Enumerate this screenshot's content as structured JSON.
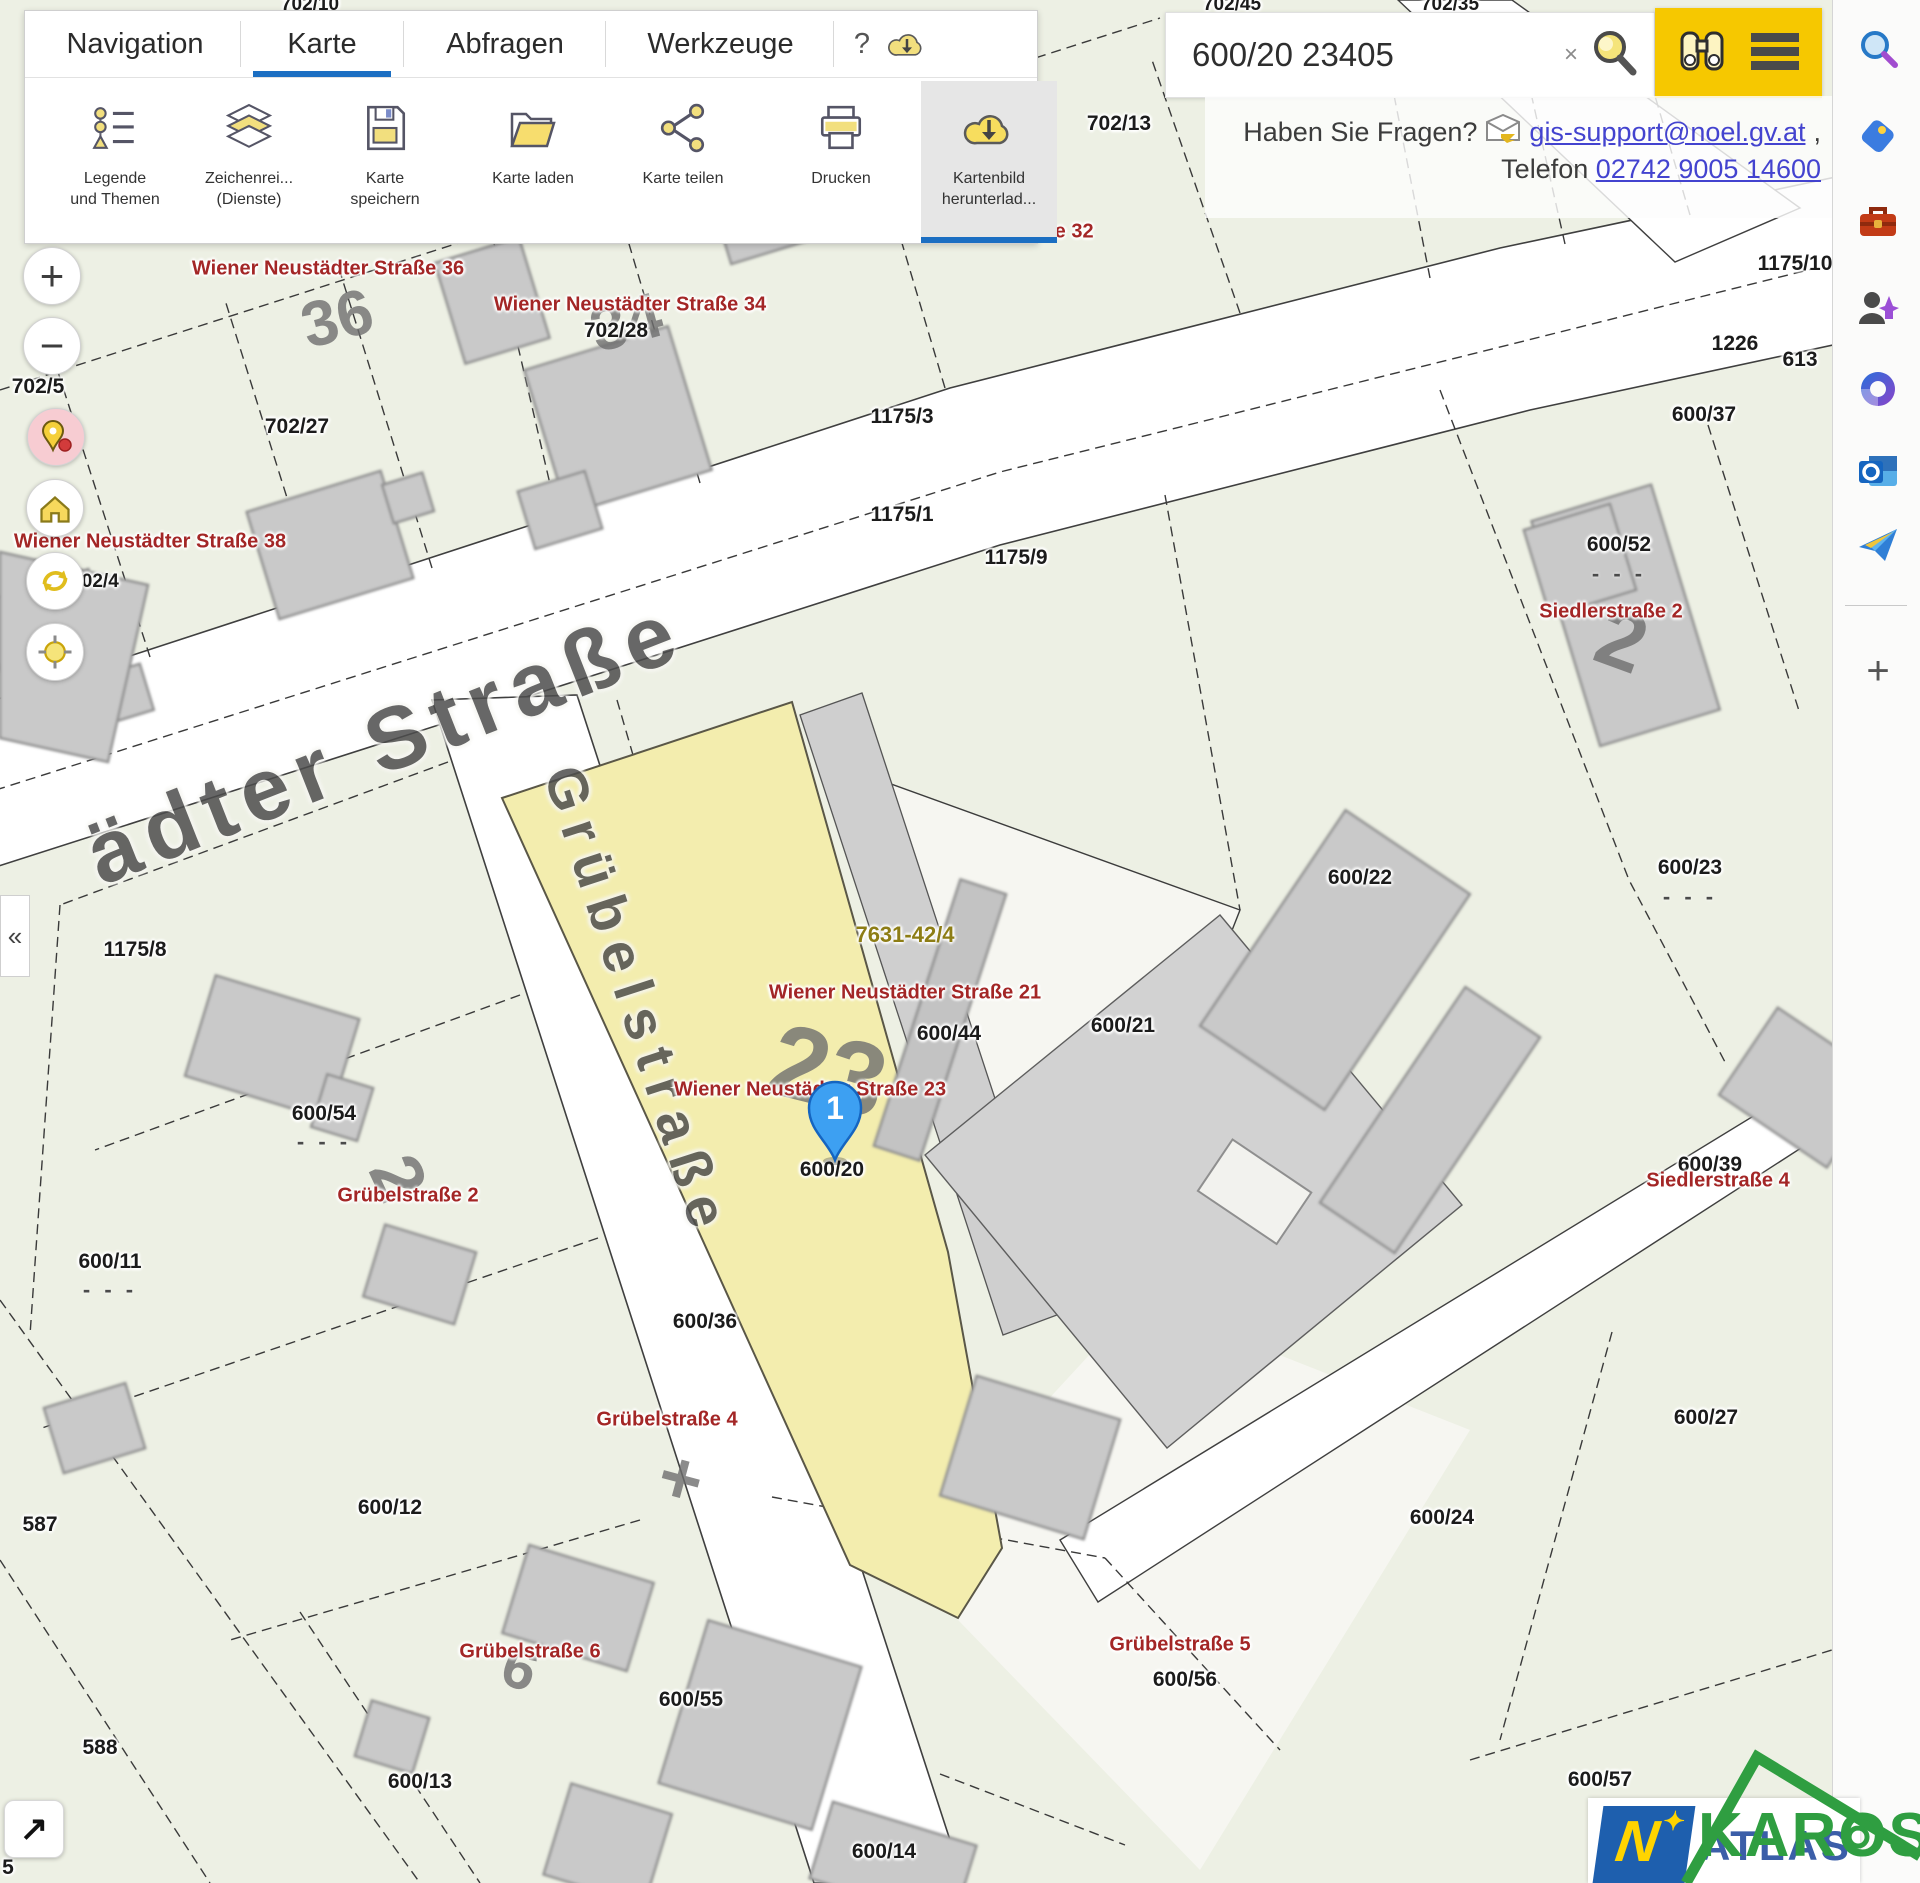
{
  "colors": {
    "accent_blue": "#1b6ec2",
    "button_yellow": "#f6c800",
    "parcel_yellow": "#f3edae",
    "label_red": "#a32626",
    "label_olive": "#8d7d15",
    "watermark_green": "#2f9e41",
    "logo_blue": "#1e5fae"
  },
  "header": {
    "tabs": [
      {
        "label": "Navigation"
      },
      {
        "label": "Karte",
        "active": true
      },
      {
        "label": "Abfragen"
      },
      {
        "label": "Werkzeuge"
      }
    ],
    "help": "?",
    "buttons": [
      {
        "line1": "Legende",
        "line2": "und Themen",
        "icon": "legend-icon"
      },
      {
        "line1": "Zeichenrei...",
        "line2": "(Dienste)",
        "icon": "layers-icon"
      },
      {
        "line1": "Karte",
        "line2": "speichern",
        "icon": "save-icon"
      },
      {
        "line1": "Karte laden",
        "line2": "",
        "icon": "folder-open-icon"
      },
      {
        "line1": "Karte teilen",
        "line2": "",
        "icon": "share-icon"
      },
      {
        "line1": "Drucken",
        "line2": "",
        "icon": "printer-icon"
      },
      {
        "line1": "Kartenbild",
        "line2": "herunterlad...",
        "icon": "cloud-download-icon",
        "active": true
      }
    ]
  },
  "search": {
    "value": "600/20 23405",
    "clear": "×"
  },
  "contact": {
    "question": "Haben Sie Fragen?",
    "email": "gis-support@noel.gv.at",
    "comma": " ,",
    "telefon_label": "Telefon",
    "phone": "02742 9005 14600"
  },
  "controls": {
    "zoom_in": "+",
    "zoom_out": "−",
    "collapse": "«",
    "fullscreen": "↗"
  },
  "marker": {
    "number": "1"
  },
  "logo": {
    "n": "N",
    "star": "✦",
    "atlas": "ATLAS"
  },
  "watermark": {
    "text": "KAROS"
  },
  "map": {
    "parcel_labels": [
      {
        "text": "702/10",
        "x": 310,
        "y": 5,
        "size": 19
      },
      {
        "text": "702/45",
        "x": 1232,
        "y": 5,
        "size": 19
      },
      {
        "text": "702/35",
        "x": 1450,
        "y": 5,
        "size": 19
      },
      {
        "text": "17",
        "x": 1906,
        "y": 8,
        "size": 19
      },
      {
        "text": "702/13",
        "x": 1119,
        "y": 124
      },
      {
        "text": "702/32",
        "x": 1252,
        "y": 87
      },
      {
        "text": "702/5",
        "x": 38,
        "y": 387
      },
      {
        "text": "702/27",
        "x": 297,
        "y": 427
      },
      {
        "text": "702/28",
        "x": 616,
        "y": 331
      },
      {
        "text": "702/4",
        "x": 95,
        "y": 582,
        "size": 19
      },
      {
        "text": "1175/3",
        "x": 902,
        "y": 417
      },
      {
        "text": "1175/1",
        "x": 902,
        "y": 515
      },
      {
        "text": "1175/9",
        "x": 1016,
        "y": 558
      },
      {
        "text": "1175/10",
        "x": 1795,
        "y": 264
      },
      {
        "text": "1226",
        "x": 1735,
        "y": 344
      },
      {
        "text": "613",
        "x": 1800,
        "y": 360
      },
      {
        "text": "600/37",
        "x": 1704,
        "y": 415
      },
      {
        "text": "600/52",
        "x": 1619,
        "y": 545
      },
      {
        "text": "600/22",
        "x": 1360,
        "y": 878
      },
      {
        "text": "600/23",
        "x": 1690,
        "y": 868
      },
      {
        "text": "1175/8",
        "x": 135,
        "y": 950
      },
      {
        "text": "600/44",
        "x": 949,
        "y": 1034
      },
      {
        "text": "600/21",
        "x": 1123,
        "y": 1026
      },
      {
        "text": "600/54",
        "x": 324,
        "y": 1114
      },
      {
        "text": "600/20",
        "x": 832,
        "y": 1170
      },
      {
        "text": "600/11",
        "x": 110,
        "y": 1262
      },
      {
        "text": "600/36",
        "x": 705,
        "y": 1322
      },
      {
        "text": "600/39",
        "x": 1710,
        "y": 1165
      },
      {
        "text": "600/27",
        "x": 1706,
        "y": 1418
      },
      {
        "text": "600/12",
        "x": 390,
        "y": 1508
      },
      {
        "text": "587",
        "x": 40,
        "y": 1525
      },
      {
        "text": "600/24",
        "x": 1442,
        "y": 1518
      },
      {
        "text": "600/56",
        "x": 1185,
        "y": 1680
      },
      {
        "text": "600/55",
        "x": 691,
        "y": 1700
      },
      {
        "text": "588",
        "x": 100,
        "y": 1748
      },
      {
        "text": "600/13",
        "x": 420,
        "y": 1782
      },
      {
        "text": "600/57",
        "x": 1600,
        "y": 1780
      },
      {
        "text": "600/14",
        "x": 884,
        "y": 1852
      },
      {
        "text": "5",
        "x": 8,
        "y": 1868
      }
    ],
    "address_labels": [
      {
        "text": "Wiener Neustädter Straße 36",
        "x": 328,
        "y": 269
      },
      {
        "text": "Wiener Neustädter Straße 34",
        "x": 630,
        "y": 305
      },
      {
        "text": "ße 32",
        "x": 1068,
        "y": 232
      },
      {
        "text": "Wiener Neustädter Straße 36",
        "x": 1345,
        "y": 86
      },
      {
        "text": "Wiener Neustädter Straße 38",
        "x": 150,
        "y": 542
      },
      {
        "text": "Siedlerstraße 2",
        "x": 1611,
        "y": 612
      },
      {
        "text": "Wiener Neustädter Straße 21",
        "x": 905,
        "y": 993
      },
      {
        "text": "Wiener Neustädter Straße 23",
        "x": 810,
        "y": 1090
      },
      {
        "text": "Grübelstraße 2",
        "x": 408,
        "y": 1196
      },
      {
        "text": "Siedlerstraße 4",
        "x": 1718,
        "y": 1181
      },
      {
        "text": "Grübelstraße 4",
        "x": 667,
        "y": 1420
      },
      {
        "text": "Grübelstraße 6",
        "x": 530,
        "y": 1652
      },
      {
        "text": "Grübelstraße 5",
        "x": 1180,
        "y": 1645
      }
    ],
    "survey_label": {
      "text": "7631-42/4",
      "x": 905,
      "y": 935
    },
    "street_labels": [
      {
        "text": "ädter Straße",
        "x": 385,
        "y": 742,
        "rot": -21.5,
        "size": 88,
        "ls": 10
      },
      {
        "text": "Grübelstraße",
        "x": 638,
        "y": 1002,
        "rot": 72,
        "size": 56,
        "ls": 12
      }
    ],
    "house_numbers": [
      {
        "text": "36",
        "x": 337,
        "y": 318,
        "rot": -15,
        "size": 64
      },
      {
        "text": "34",
        "x": 626,
        "y": 322,
        "rot": -15,
        "size": 64
      },
      {
        "text": "23",
        "x": 828,
        "y": 1072,
        "rot": 14,
        "size": 104
      },
      {
        "text": "2",
        "x": 1622,
        "y": 640,
        "rot": 20,
        "size": 84
      },
      {
        "text": "2",
        "x": 398,
        "y": 1178,
        "rot": 65,
        "size": 72
      },
      {
        "text": "6",
        "x": 520,
        "y": 1668,
        "rot": 20,
        "size": 60
      },
      {
        "text": "+",
        "x": 681,
        "y": 1478,
        "rot": 15,
        "size": 74
      }
    ],
    "dash_marks": [
      {
        "text": "- - -",
        "x": 1619,
        "y": 574
      },
      {
        "text": "- - -",
        "x": 1690,
        "y": 897
      },
      {
        "text": "- - -",
        "x": 324,
        "y": 1142
      },
      {
        "text": "- - -",
        "x": 110,
        "y": 1290
      }
    ]
  },
  "sidebar": {
    "icons": [
      "search",
      "shopping",
      "toolbox",
      "people",
      "microsoft-365",
      "outlook",
      "send"
    ],
    "add": "+"
  }
}
